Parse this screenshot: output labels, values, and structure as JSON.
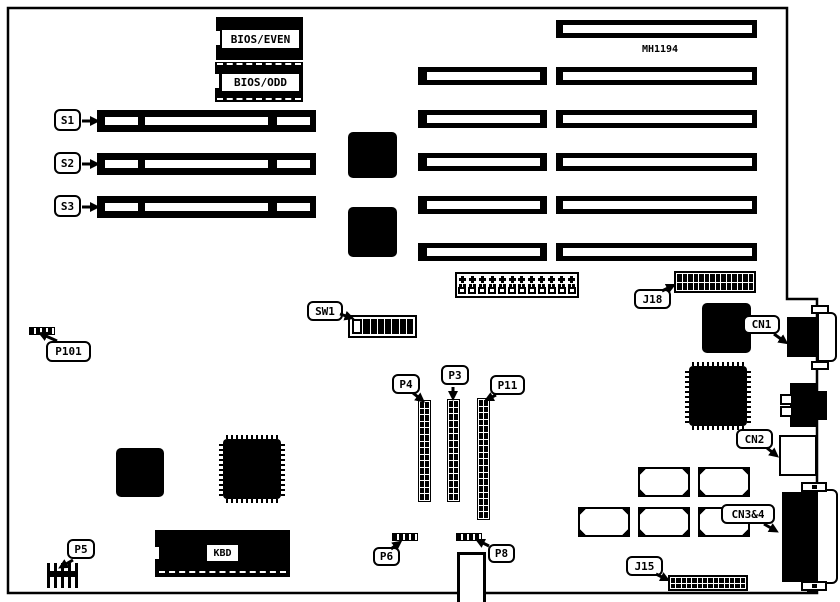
{
  "board": {
    "part_number": "MH1194",
    "rom": {
      "even": "BIOS/EVEN",
      "odd": "BIOS/ODD"
    },
    "memory_sockets": [
      {
        "label": "S1"
      },
      {
        "label": "S2"
      },
      {
        "label": "S3"
      }
    ],
    "keyboard_chip": "KBD",
    "callouts": {
      "sw1": "SW1",
      "p101": "P101",
      "p4": "P4",
      "p3": "P3",
      "p11": "P11",
      "p5": "P5",
      "p6": "P6",
      "p8": "P8",
      "j18": "J18",
      "j15": "J15",
      "cn1": "CN1",
      "cn2": "CN2",
      "cn34": "CN3&4"
    },
    "components": {
      "dip_switch": {
        "positions": [
          "off",
          "on",
          "on",
          "on",
          "on",
          "on",
          "on",
          "on"
        ]
      },
      "power_connector": {
        "sections": 12
      },
      "j18_header": {
        "cols": 14
      },
      "j15_header": {
        "cols": 14
      },
      "p4_header": {
        "rows": 15
      },
      "p3_header": {
        "rows": 15
      },
      "p11_header": {
        "rows": 18
      },
      "expansion_slots": {
        "mid_column": 5,
        "right_column": 5,
        "top_right": 1
      },
      "socket_footprints": {
        "count": 5
      }
    },
    "colors": {
      "ink": "#000000",
      "paper": "#ffffff"
    }
  }
}
